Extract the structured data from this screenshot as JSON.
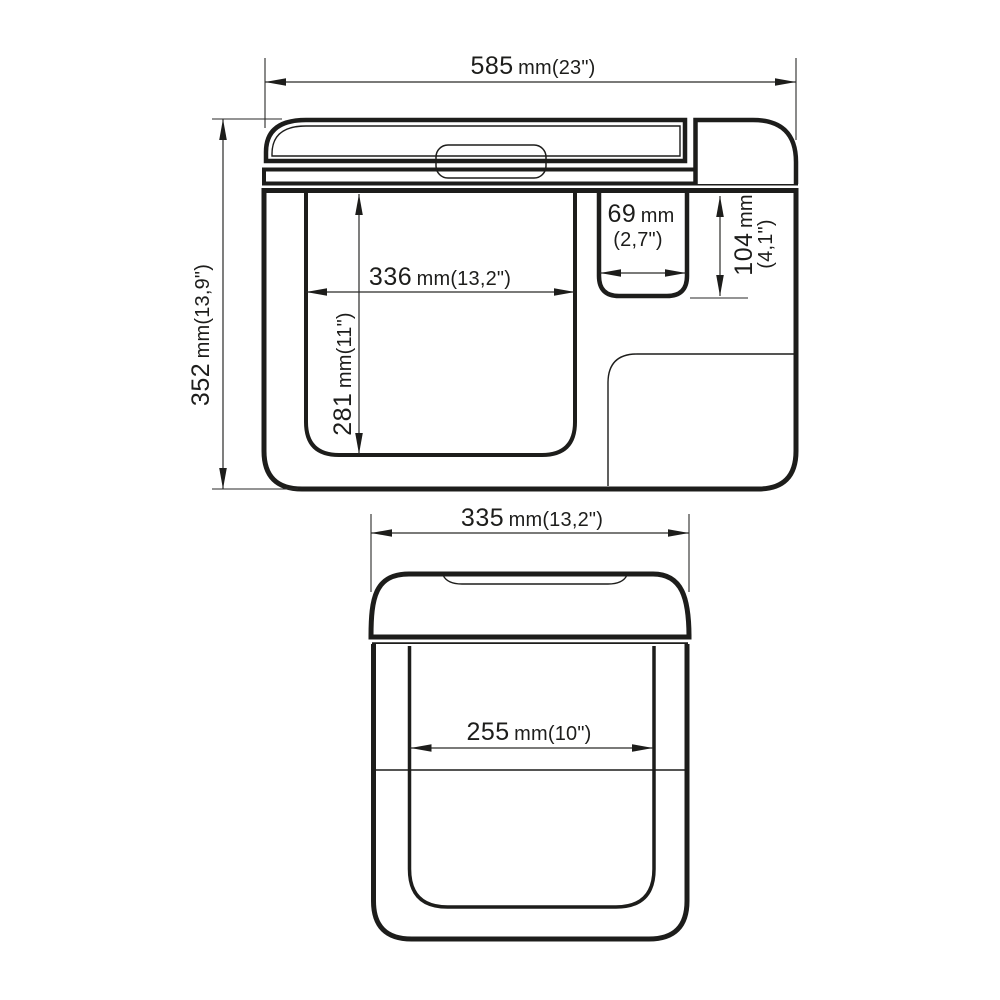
{
  "page": {
    "background": "#ffffff",
    "line_color": "#1d1d1b",
    "description": "Technical dimension drawing of a portable cooler box, side cross-section view and front view"
  },
  "views": {
    "side": {
      "label": "side-section-view",
      "dims": {
        "overall_width": {
          "value": "585",
          "unit": "mm(23\")"
        },
        "overall_height": {
          "value": "352",
          "unit": "mm(13,9\")"
        },
        "cavity_width": {
          "value": "336",
          "unit": "mm(13,2\")"
        },
        "cavity_depth": {
          "value": "281",
          "unit": "mm(11\")"
        },
        "small_cavity_width": {
          "value": "69",
          "unit": "mm",
          "alt": "(2,7\")"
        },
        "small_cavity_depth": {
          "value": "104",
          "unit": "mm",
          "alt": "(4,1\")"
        }
      }
    },
    "front": {
      "label": "front-view",
      "dims": {
        "overall_width": {
          "value": "335",
          "unit": "mm(13,2\")"
        },
        "cavity_width": {
          "value": "255",
          "unit": "mm(10\")"
        }
      }
    }
  }
}
